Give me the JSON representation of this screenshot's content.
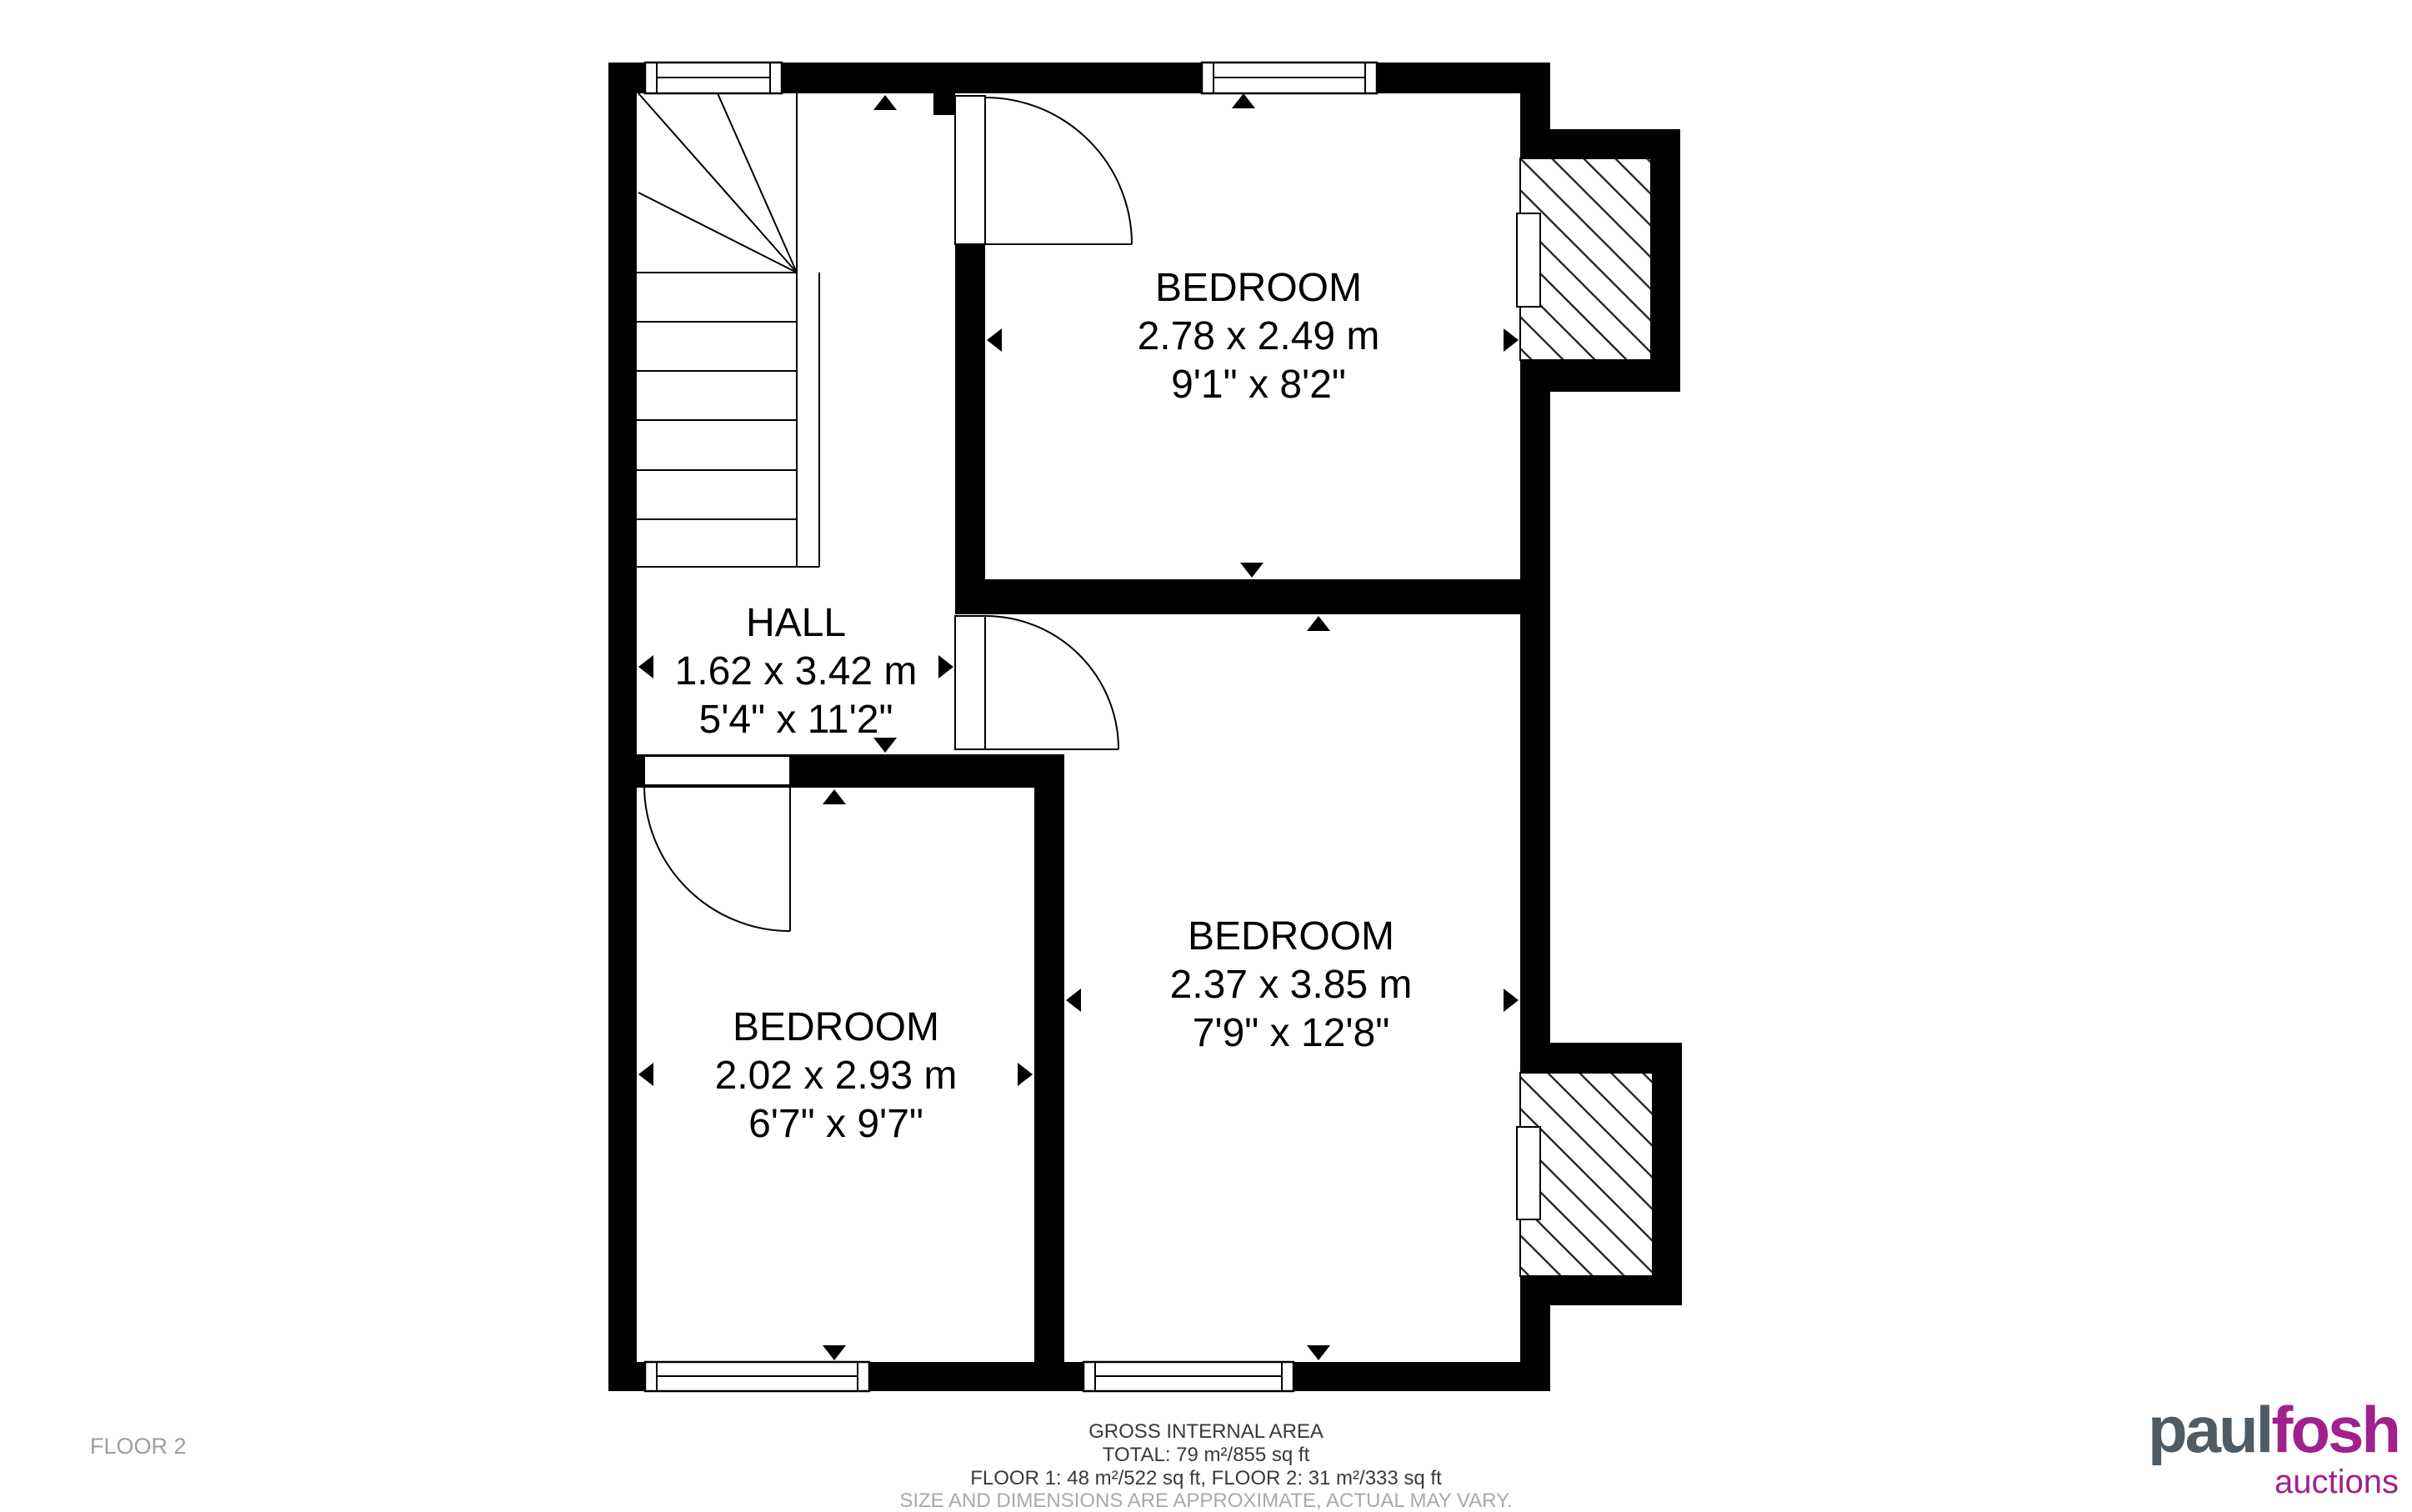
{
  "floor_label": "FLOOR 2",
  "rooms": [
    {
      "id": "bedroom-top",
      "name": "BEDROOM",
      "metric": "2.78 x 2.49 m",
      "imperial": "9'1\" x 8'2\""
    },
    {
      "id": "hall",
      "name": "HALL",
      "metric": "1.62 x 3.42 m",
      "imperial": "5'4\" x 11'2\""
    },
    {
      "id": "bedroom-middle",
      "name": "BEDROOM",
      "metric": "2.37 x 3.85 m",
      "imperial": "7'9\" x 12'8\""
    },
    {
      "id": "bedroom-bottom-left",
      "name": "BEDROOM",
      "metric": "2.02 x 2.93 m",
      "imperial": "6'7\" x 9'7\""
    }
  ],
  "footer": {
    "line1": "GROSS INTERNAL AREA",
    "line2": "TOTAL: 79 m²/855 sq ft",
    "line3": "FLOOR 1: 48 m²/522 sq ft, FLOOR 2: 31 m²/333 sq ft",
    "disclaimer": "SIZE AND DIMENSIONS ARE APPROXIMATE, ACTUAL MAY VARY."
  },
  "logo": {
    "part1": "paul",
    "part2": "fosh",
    "part3": "auctions"
  },
  "colors": {
    "wall": "#000000",
    "background": "#ffffff",
    "logo_gray": "#515b64",
    "logo_purple": "#a0218c",
    "muted_text": "#9e9e9e",
    "footer_text": "#3a3a3a"
  }
}
